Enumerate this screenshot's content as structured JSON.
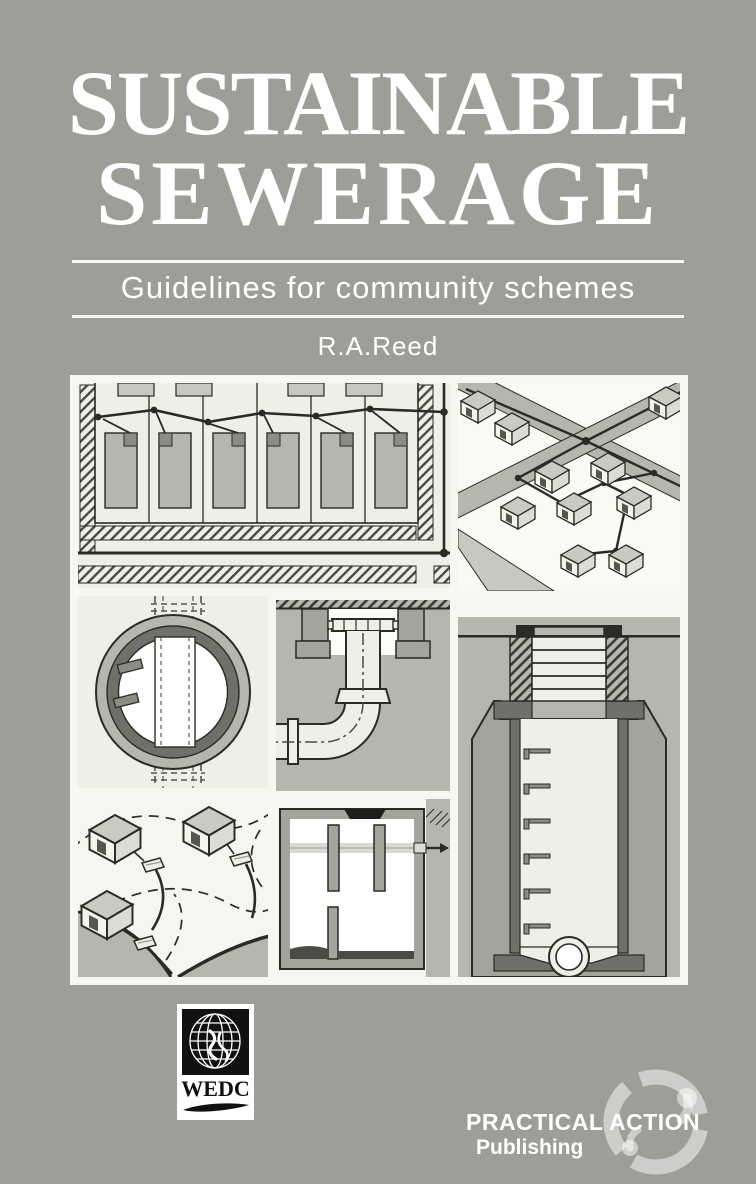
{
  "window": {
    "width": 756,
    "height": 1184
  },
  "cover": {
    "title_line1": "SUSTAINABLE",
    "title_line2": "SEWERAGE",
    "subtitle": "Guidelines for community schemes",
    "author": "R.A.Reed"
  },
  "montage": {
    "panels": [
      {
        "name": "sewer-plan-view",
        "label": "Plan view of housing plots with backyard sewer main and junction dots"
      },
      {
        "name": "isometric-neighbourhood",
        "label": "Isometric view of houses connected by sewer lines to street mains"
      },
      {
        "name": "manhole-ring-plan",
        "label": "Plan of circular manhole ring over a sewer pipe"
      },
      {
        "name": "access-bend-section",
        "label": "Section through access cover and 90-degree pipe bend"
      },
      {
        "name": "deep-manhole-section",
        "label": "Section through deep manhole with step irons and invert channel"
      },
      {
        "name": "hillside-houses",
        "label": "Houses with interceptor tanks on a contoured hillside"
      },
      {
        "name": "septic-tank-section",
        "label": "Section through septic tank with baffles and outlet arrow"
      }
    ]
  },
  "logos": {
    "wedc": {
      "label": "WEDC"
    },
    "practical_action": {
      "line1": "PRACTICAL ACTION",
      "line2": "Publishing"
    }
  },
  "colors": {
    "background": "#9C9E98",
    "text": "#FFFFFF",
    "panel_paper": "#F0EFE7",
    "montage_backing": "#F7F6F1",
    "drawing_mid_gray": "#B5B7AF",
    "drawing_light_gray": "#C7C9C1",
    "drawing_dark_gray": "#6E7069",
    "line": "#2A2A26",
    "wedc_black": "#111111"
  }
}
